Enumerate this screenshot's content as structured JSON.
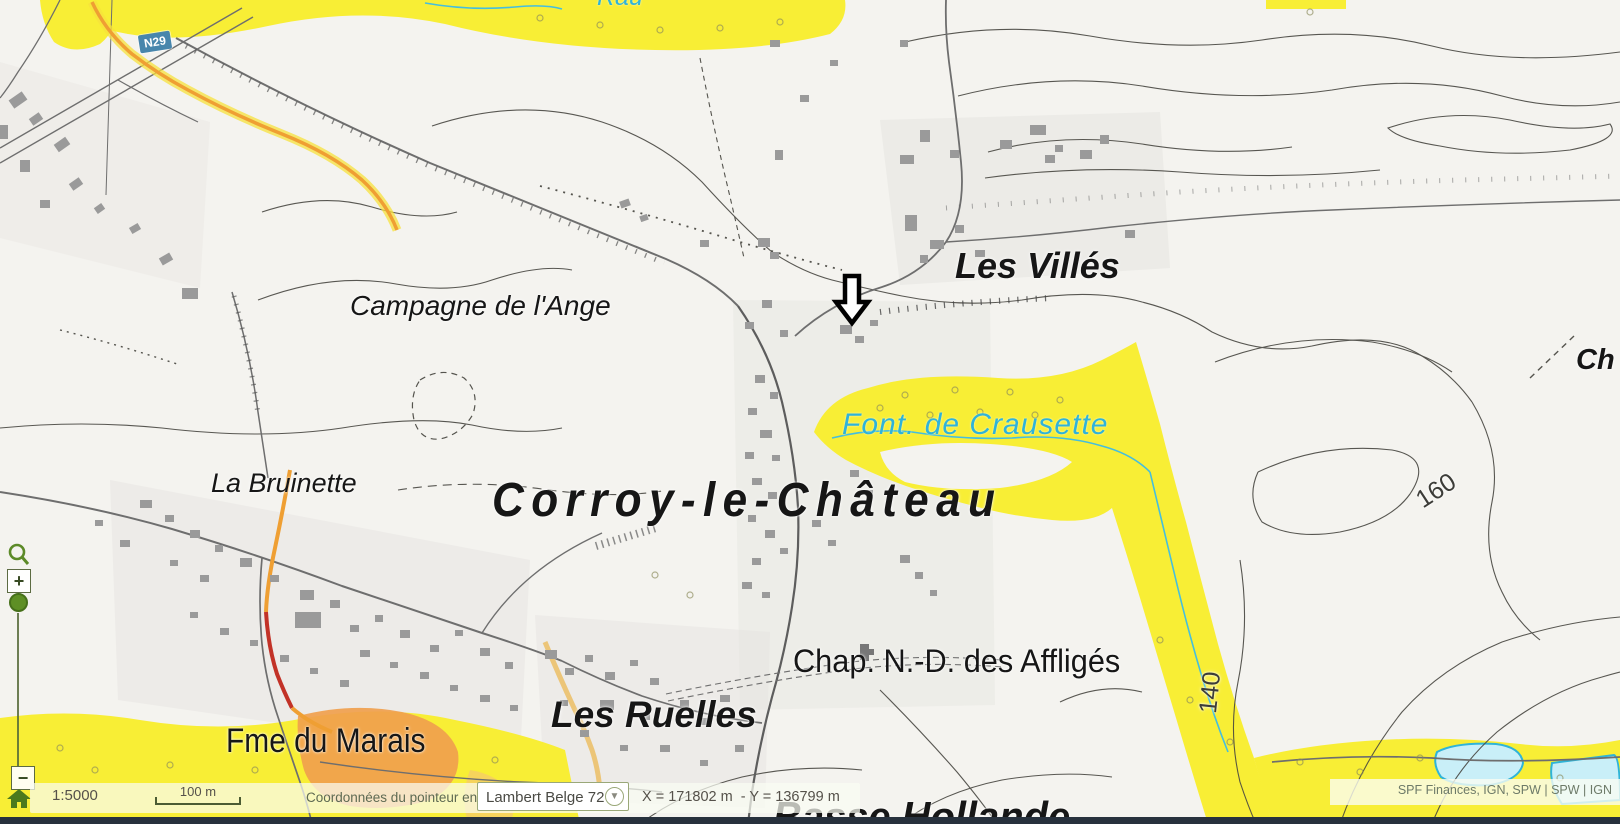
{
  "map": {
    "place_labels": {
      "campagne": "Campagne de l'Ange",
      "les_villes": "Les Villés",
      "la_bruinette": "La Bruinette",
      "corroy": "Corroy-le-Château",
      "font_crausette": "Font. de Crausette",
      "chapelle": "Chap. N.-D. des Affligés",
      "les_ruelles": "Les Ruelles",
      "fme_marais": "Fme du Marais",
      "basse_hollande": "Basse Hollande",
      "edge_partial_right": "Ch",
      "edge_partial_top": "Rau"
    },
    "contour_labels": {
      "c160": "160",
      "c140": "140"
    },
    "road_shield": "N29",
    "colors": {
      "built_zone_yellow": "#f8ee35",
      "water_cyan": "#3ab6dc",
      "route_orange": "#ef9f33",
      "route_red": "#c23227",
      "building_gray": "#9a9a9a",
      "control_green": "#5e8f25"
    }
  },
  "controls": {
    "zoom_in": "+",
    "zoom_out": "−",
    "dropdown_chevron": "▼"
  },
  "status_bar": {
    "scale": "1:5000",
    "scale_bar": "100 m",
    "pointer_label": "Coordonnées du pointeur en",
    "crs": "Lambert Belge 72",
    "coordinates": "X = 171802 m  - Y = 136799 m",
    "attribution": "SPF Finances, IGN, SPW | SPW | IGN"
  }
}
